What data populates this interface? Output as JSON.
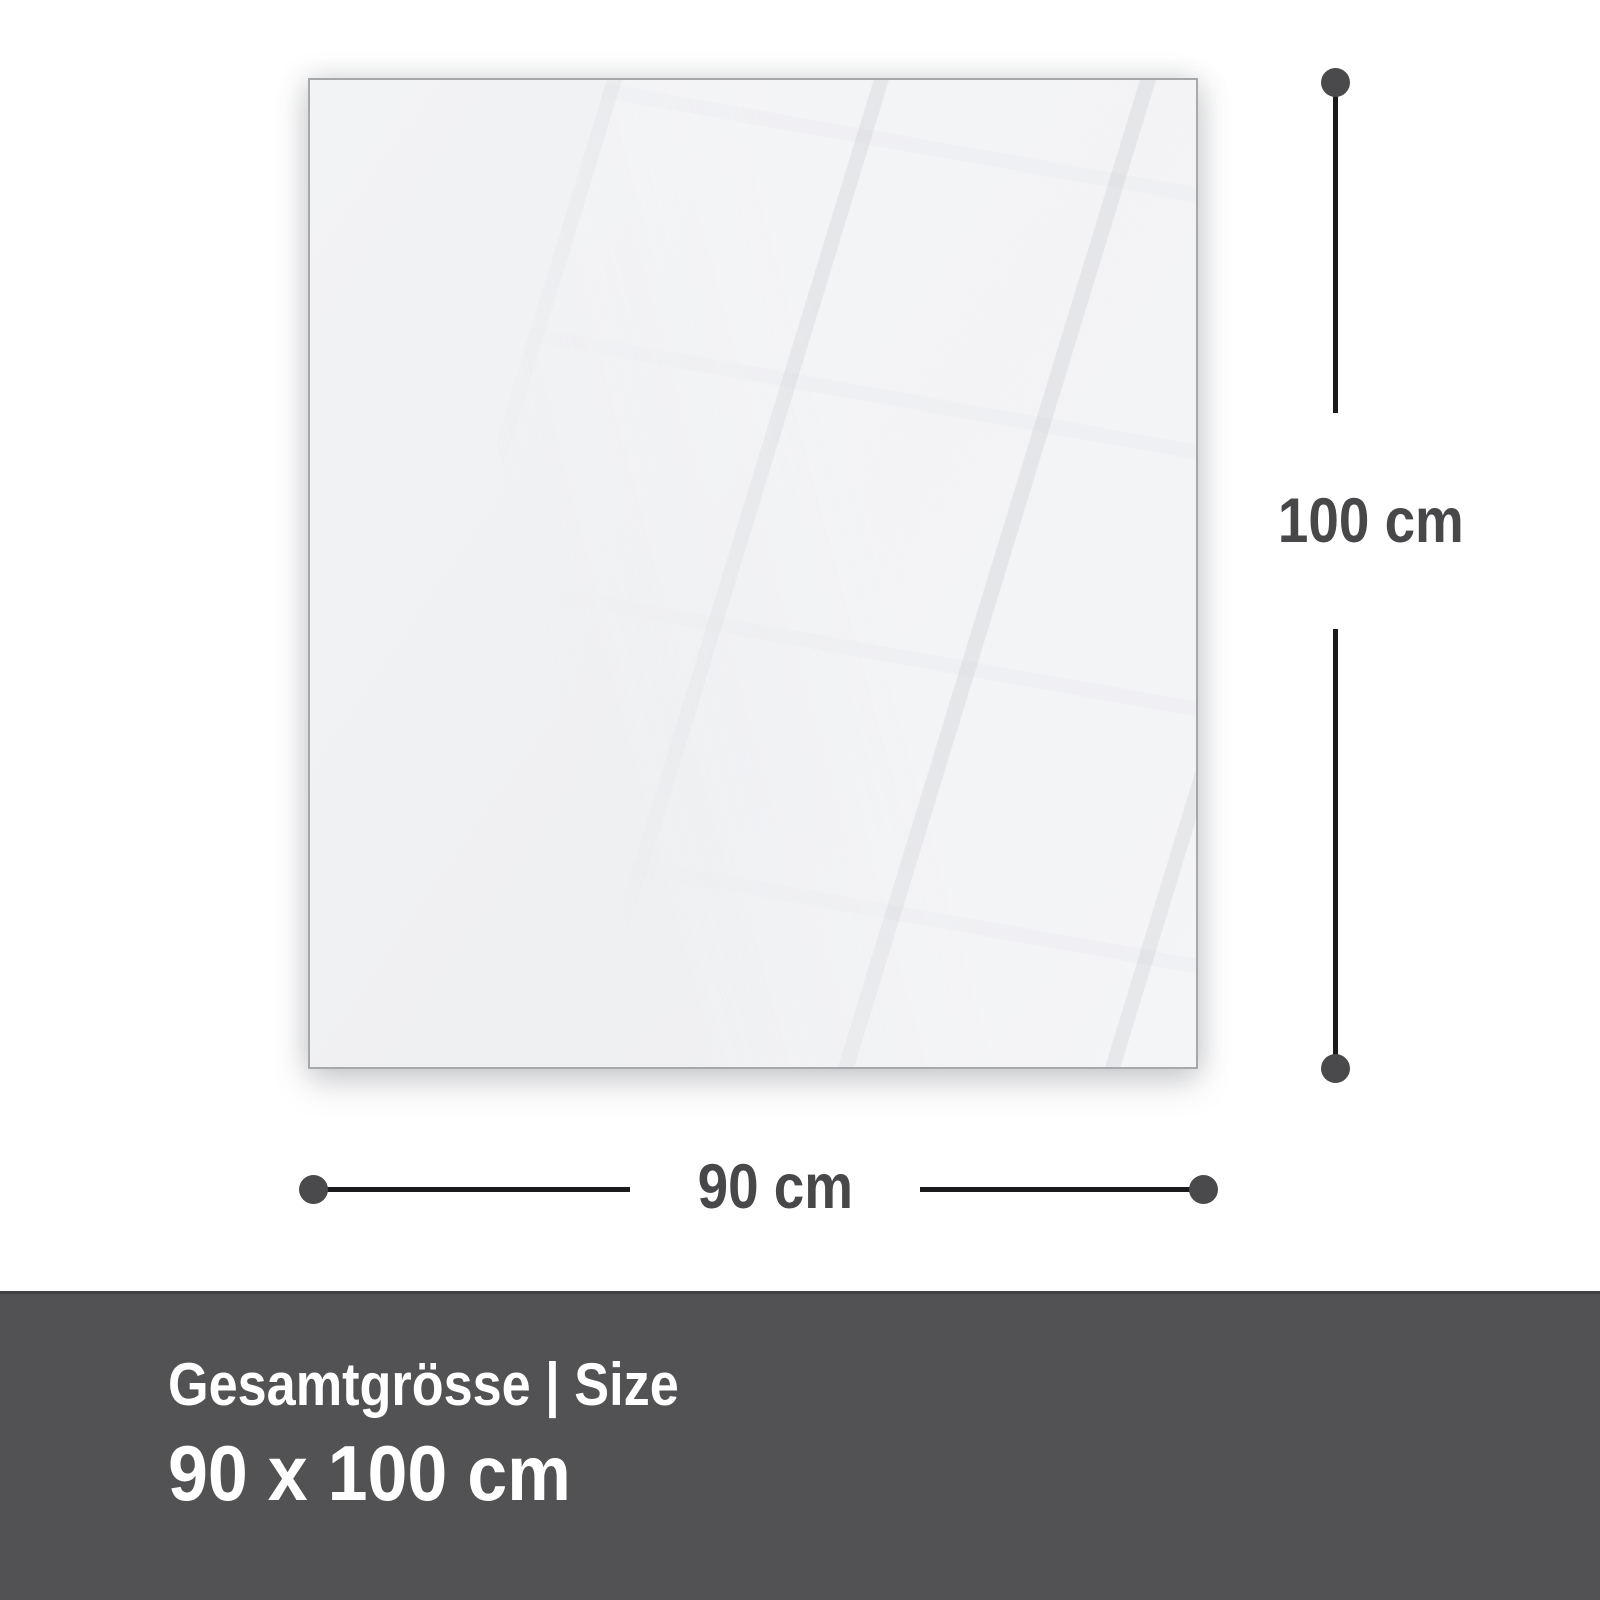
{
  "page": {
    "background": "#ffffff",
    "type": "product-size-diagram"
  },
  "panel": {
    "description": "blank glossy glass panel with window reflection",
    "fill": "#f0f1f3",
    "border_color": "#a6a8aa"
  },
  "dimensions": {
    "height": {
      "label": "100 cm"
    },
    "width": {
      "label": "90 cm"
    },
    "line_color": "#1b1b1d",
    "dot_color": "#4a4a4c",
    "label_color": "#48484a"
  },
  "footer": {
    "background": "#525254",
    "title": "Gesamtgrösse | Size",
    "size": "90 x 100 cm",
    "text_color": "#ffffff"
  }
}
